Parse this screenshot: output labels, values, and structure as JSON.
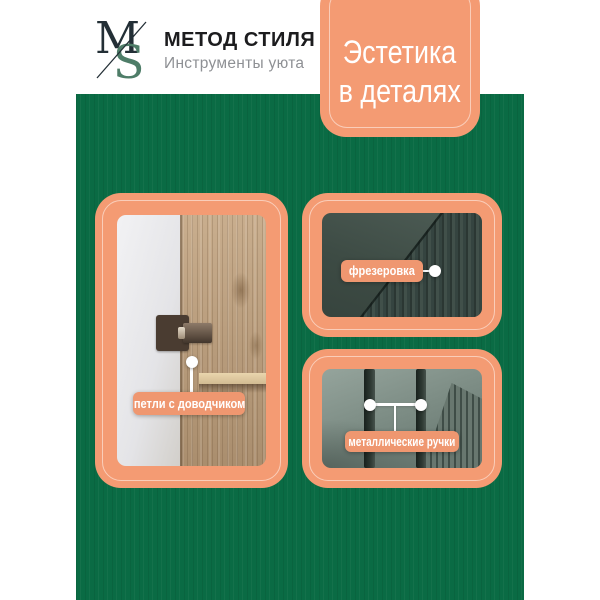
{
  "colors": {
    "background_green": "#0A6B44",
    "accent_salmon": "#F49B73",
    "label_salmon": "#EF9770",
    "logo_green": "#4E7D68",
    "logo_dark": "#232F36",
    "tagline_gray": "#8E9094"
  },
  "brand": {
    "monogram_m": "M",
    "monogram_s": "S",
    "name": "МЕТОД СТИЛЯ",
    "tagline": "Инструменты уюта"
  },
  "badge": {
    "line1": "Эстетика",
    "line2": "в деталях"
  },
  "features": {
    "hinges": {
      "label": "петли с доводчиком"
    },
    "milling": {
      "label": "фрезеровка"
    },
    "handles": {
      "label": "металлические ручки"
    }
  }
}
